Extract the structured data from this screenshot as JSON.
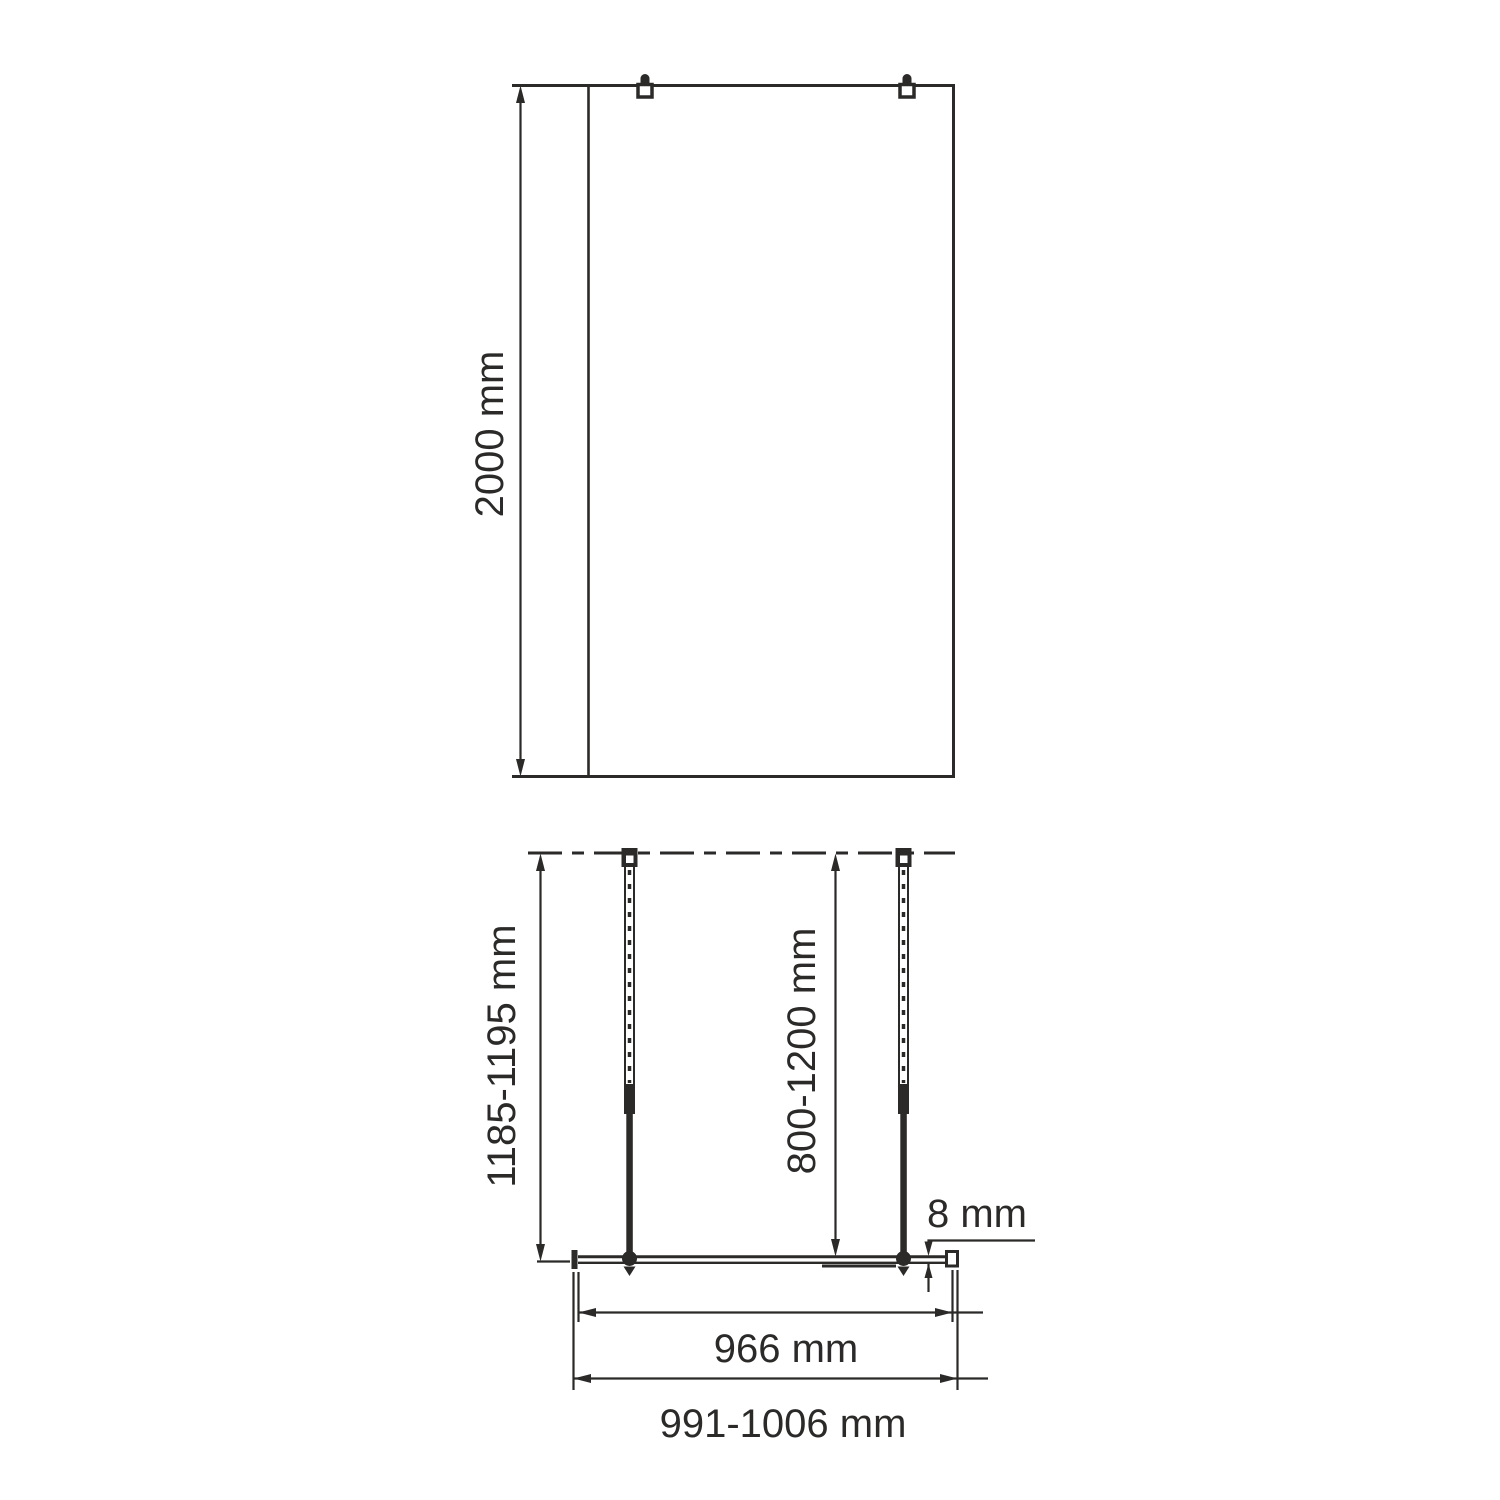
{
  "colors": {
    "line": "#2b2a29",
    "background": "#ffffff"
  },
  "front_view": {
    "height_label": "2000 mm"
  },
  "plan_view": {
    "depth_label": "1185-1195 mm",
    "bar_length_label": "800-1200 mm",
    "glass_thickness_label": "8 mm",
    "glass_width_label": "966 mm",
    "overall_width_label": "991-1006 mm"
  }
}
